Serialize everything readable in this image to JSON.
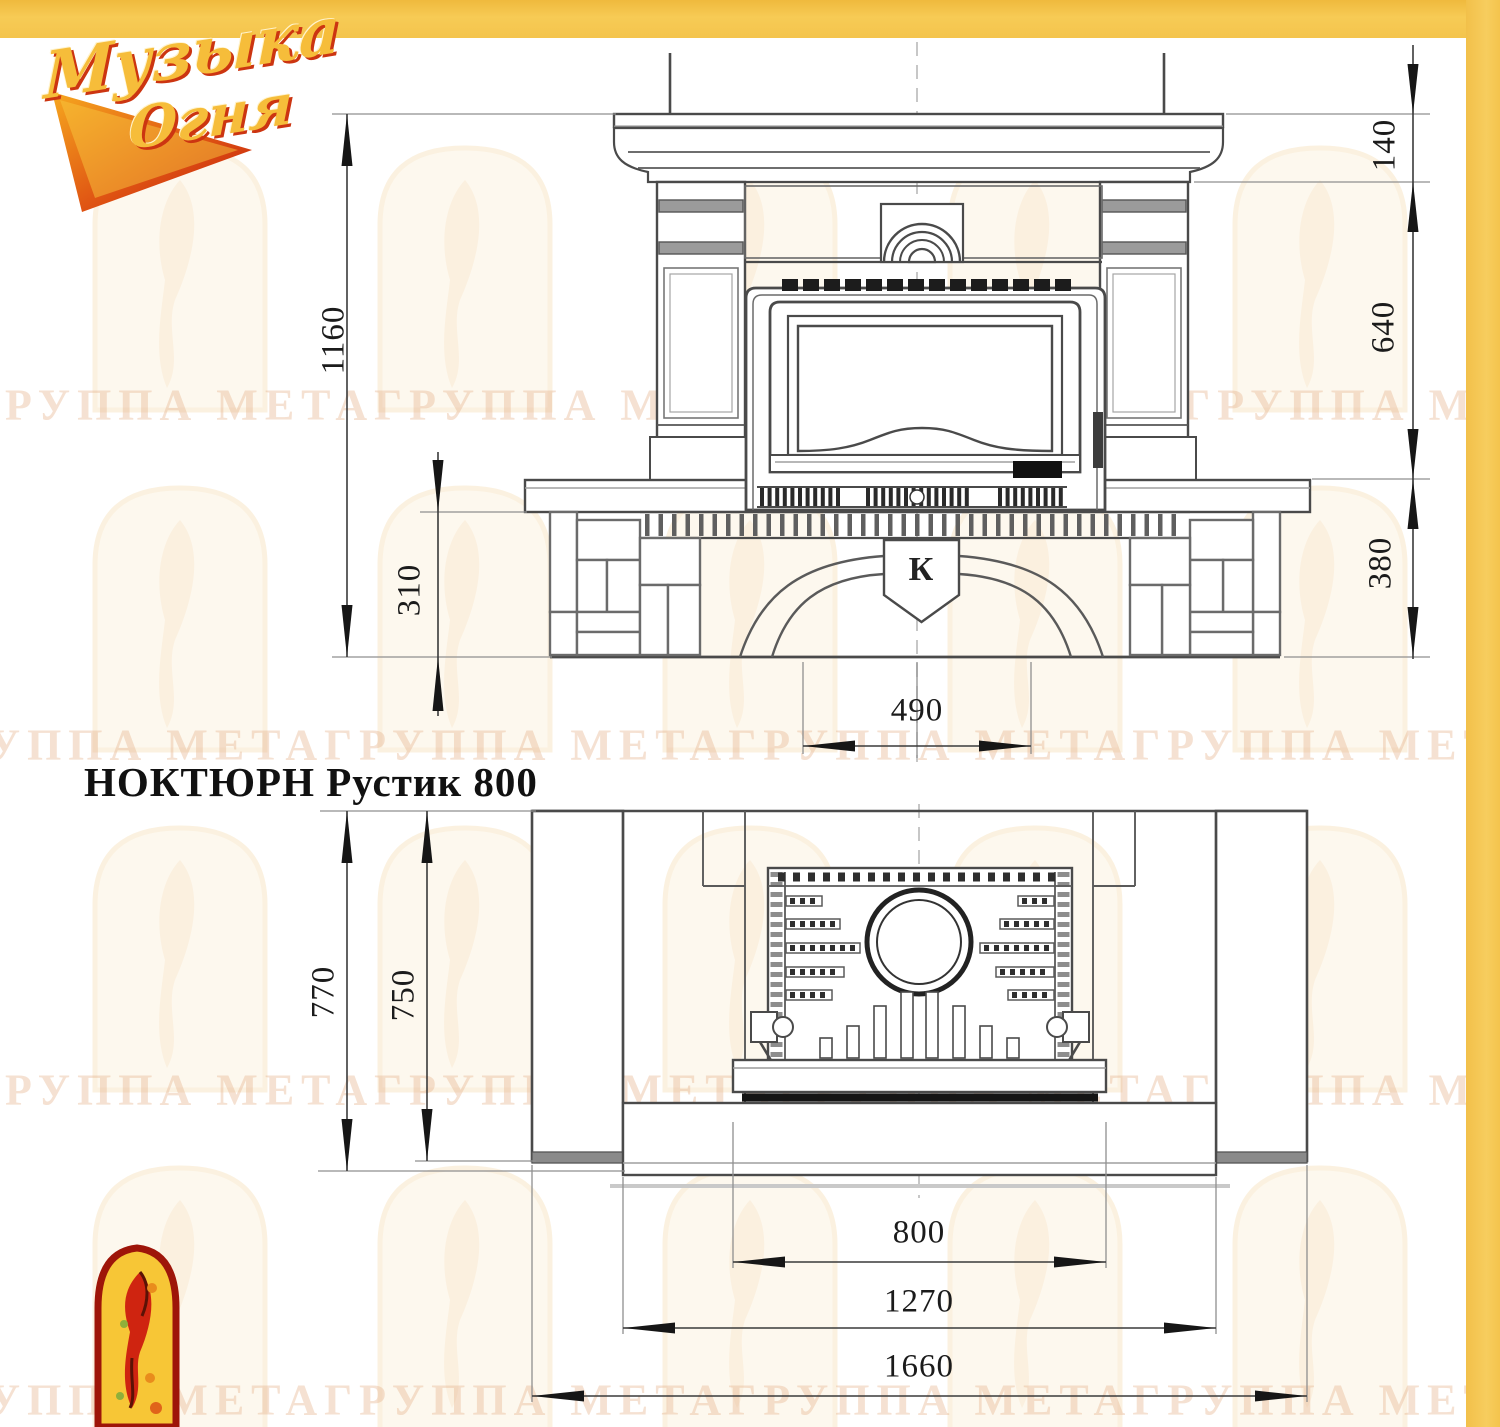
{
  "title": "НОКТЮРН Рустик 800",
  "logo": {
    "word1": "Музыка",
    "word2": "Огня"
  },
  "watermark_text": "ГРУППА МЕТАГРУППА МЕТАГРУППА МЕТАГРУППА МЕТА",
  "front_view": {
    "emblem_letter": "К",
    "dims": {
      "total_height": "1160",
      "plinth_height": "310",
      "shelf_height": "140",
      "middle_height": "640",
      "base_height": "380",
      "opening_width": "490"
    }
  },
  "plan_view": {
    "dims": {
      "total_depth": "770",
      "body_depth": "750",
      "insert_width": "800",
      "hearth_width": "1270",
      "total_width": "1660"
    }
  },
  "colors": {
    "accent_yellow": "#f5c84e",
    "line_dark": "#3f3f3f",
    "watermark": "#e7b58f",
    "logo_red": "#cc3511",
    "logo_gold": "#f6bd3a"
  }
}
